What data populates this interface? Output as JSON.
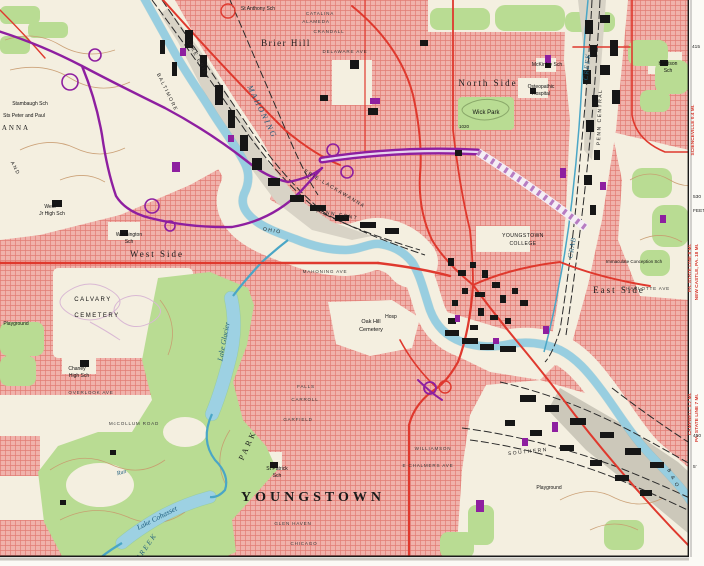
{
  "colors": {
    "urban_pink": "#f0b2ab",
    "urban_grid": "#dd6a62",
    "paper": "#f4efe0",
    "park_green": "#b9dc93",
    "water_fill": "#c2e4ef",
    "water_line": "#4aa6c6",
    "road_red": "#df392e",
    "road_purple": "#8e1fa0",
    "rail_gray": "#d8d3c6",
    "building_black": "#161616",
    "contour_brown": "#c89a6e",
    "margin_red": "#d63a30"
  },
  "labels": {
    "district": [
      {
        "t": "YOUNGSTOWN",
        "x": 313,
        "y": 501,
        "s": 14,
        "ls": 4,
        "n": "label-youngstown",
        "big": true
      },
      {
        "t": "North Side",
        "x": 488,
        "y": 86,
        "s": 9,
        "ls": 2,
        "n": "label-north-side"
      },
      {
        "t": "West Side",
        "x": 157,
        "y": 257,
        "s": 9,
        "ls": 2,
        "n": "label-west-side"
      },
      {
        "t": "East Side",
        "x": 619,
        "y": 293,
        "s": 9,
        "ls": 2,
        "n": "label-east-side"
      },
      {
        "t": "Brier Hill",
        "x": 286,
        "y": 46,
        "s": 9,
        "ls": 1.5,
        "n": "label-brier-hill"
      },
      {
        "t": "PARK",
        "x": 250,
        "y": 446,
        "r": -65,
        "s": 8,
        "ls": 3,
        "n": "label-mill-creek-park"
      },
      {
        "t": "ANNA",
        "x": 16,
        "y": 130,
        "s": 7,
        "ls": 2,
        "n": "label-anna"
      }
    ],
    "places": [
      {
        "t": "Wick Park",
        "x": 486,
        "y": 114,
        "s": 6
      },
      {
        "t": "CALVARY",
        "x": 93,
        "y": 301,
        "s": 6,
        "ls": 1.5
      },
      {
        "t": "CEMETERY",
        "x": 97,
        "y": 317,
        "s": 6,
        "ls": 1.5
      },
      {
        "t": "Oak Hill",
        "x": 371,
        "y": 323,
        "s": 5.5
      },
      {
        "t": "Cemetery",
        "x": 371,
        "y": 331,
        "s": 5.5
      },
      {
        "t": "Hosp",
        "x": 391,
        "y": 318,
        "s": 5
      },
      {
        "t": "YOUNGSTOWN",
        "x": 523,
        "y": 237,
        "s": 5,
        "ls": 0.5
      },
      {
        "t": "COLLEGE",
        "x": 523,
        "y": 245,
        "s": 5,
        "ls": 0.5
      },
      {
        "t": "St Anthony Sch",
        "x": 258,
        "y": 10,
        "s": 5
      },
      {
        "t": "Stambaugh Sch",
        "x": 30,
        "y": 105,
        "s": 5
      },
      {
        "t": "Sts Peter and Paul",
        "x": 24,
        "y": 117,
        "s": 5
      },
      {
        "t": "West",
        "x": 50,
        "y": 208,
        "s": 5
      },
      {
        "t": "Jr High Sch",
        "x": 52,
        "y": 215,
        "s": 5
      },
      {
        "t": "Washington",
        "x": 129,
        "y": 236,
        "s": 5
      },
      {
        "t": "Sch",
        "x": 129,
        "y": 243,
        "s": 5
      },
      {
        "t": "Chaney",
        "x": 77,
        "y": 370,
        "s": 5
      },
      {
        "t": "High Sch",
        "x": 79,
        "y": 377,
        "s": 5
      },
      {
        "t": "St Patrick",
        "x": 277,
        "y": 470,
        "s": 5
      },
      {
        "t": "Sch",
        "x": 277,
        "y": 477,
        "s": 5
      },
      {
        "t": "McKinley Sch",
        "x": 547,
        "y": 66,
        "s": 5
      },
      {
        "t": "Osteopathic",
        "x": 541,
        "y": 88,
        "s": 5
      },
      {
        "t": "Hospital",
        "x": 541,
        "y": 95,
        "s": 5
      },
      {
        "t": "Harrison",
        "x": 668,
        "y": 65,
        "s": 5
      },
      {
        "t": "Sch",
        "x": 668,
        "y": 72,
        "s": 5
      },
      {
        "t": "Immaculate Conception Sch",
        "x": 634,
        "y": 263,
        "s": 4.5
      },
      {
        "t": "Playground",
        "x": 549,
        "y": 489,
        "s": 5
      },
      {
        "t": "Playground",
        "x": 16,
        "y": 325,
        "s": 5
      },
      {
        "t": "1020",
        "x": 464,
        "y": 128,
        "s": 4.5
      }
    ],
    "water": [
      {
        "t": "MAHONING",
        "x": 260,
        "y": 113,
        "r": 64,
        "s": 8,
        "ls": 2,
        "n": "label-mahoning-river"
      },
      {
        "t": "Lake Glacier",
        "x": 226,
        "y": 342,
        "r": -79,
        "s": 7.5,
        "n": "label-lake-glacier"
      },
      {
        "t": "Lake Cohasset",
        "x": 158,
        "y": 520,
        "r": -27,
        "s": 7.5,
        "n": "label-lake-cohasset"
      },
      {
        "t": "CREEK",
        "x": 148,
        "y": 548,
        "r": -55,
        "s": 7,
        "ls": 2,
        "n": "label-mill-creek"
      },
      {
        "t": "CRAB",
        "x": 574,
        "y": 248,
        "r": -80,
        "s": 7,
        "ls": 1,
        "n": "label-crab-creek"
      },
      {
        "t": "CREEK",
        "x": 589,
        "y": 67,
        "r": -84,
        "s": 7,
        "ls": 1,
        "n": "label-crab-creek-upper"
      },
      {
        "t": "Run",
        "x": 122,
        "y": 474,
        "r": -15,
        "s": 6,
        "n": "label-run"
      }
    ],
    "rail": [
      {
        "t": "LAKE ERIE",
        "x": 196,
        "y": 58,
        "r": 62,
        "s": 5,
        "ls": 1.5
      },
      {
        "t": "BALTIMORE",
        "x": 166,
        "y": 93,
        "r": 64,
        "s": 5,
        "ls": 1.5
      },
      {
        "t": "AND",
        "x": 14,
        "y": 169,
        "r": 62,
        "s": 5,
        "ls": 1.5
      },
      {
        "t": "ERIE-LACKAWANNA",
        "x": 334,
        "y": 190,
        "r": 31,
        "s": 5,
        "ls": 1.5
      },
      {
        "t": "PENN CENT",
        "x": 337,
        "y": 216,
        "r": 10,
        "s": 5,
        "ls": 1.5
      },
      {
        "t": "PENN CENTRAL",
        "x": 601,
        "y": 117,
        "r": -88,
        "s": 5,
        "ls": 1.5
      },
      {
        "t": "SOUTHERN",
        "x": 528,
        "y": 453,
        "r": -6,
        "s": 5,
        "ls": 1.5
      },
      {
        "t": "B & O",
        "x": 672,
        "y": 479,
        "r": 62,
        "s": 5,
        "ls": 1.5
      },
      {
        "t": "OHIO",
        "x": 272,
        "y": 232,
        "r": 10,
        "s": 5,
        "ls": 1.5
      }
    ],
    "streets": [
      {
        "t": "CATALINA",
        "x": 320,
        "y": 15,
        "s": 4.6,
        "ls": 0.8
      },
      {
        "t": "ALAMEDA",
        "x": 316,
        "y": 23,
        "s": 4.6,
        "ls": 0.8
      },
      {
        "t": "CRANDALL",
        "x": 329,
        "y": 33,
        "s": 4.6,
        "ls": 0.8
      },
      {
        "t": "DELAWARE AVE",
        "x": 345,
        "y": 53,
        "s": 4.6,
        "ls": 0.8
      },
      {
        "t": "MAHONING AVE",
        "x": 325,
        "y": 273,
        "s": 4.6,
        "ls": 0.8
      },
      {
        "t": "OVERLOOK AVE",
        "x": 91,
        "y": 394,
        "s": 4.6,
        "ls": 0.8
      },
      {
        "t": "McCOLLUM ROAD",
        "x": 134,
        "y": 425,
        "s": 4.6,
        "ls": 0.8
      },
      {
        "t": "GARFIELD",
        "x": 298,
        "y": 421,
        "s": 4.6,
        "ls": 0.8
      },
      {
        "t": "CARROLL",
        "x": 305,
        "y": 401,
        "s": 4.6,
        "ls": 0.8
      },
      {
        "t": "FALLS",
        "x": 306,
        "y": 388,
        "s": 4.6,
        "ls": 0.8
      },
      {
        "t": "GLEN HAVEN",
        "x": 293,
        "y": 525,
        "s": 4.6,
        "ls": 0.8
      },
      {
        "t": "CHICAGO",
        "x": 304,
        "y": 545,
        "s": 4.6,
        "ls": 0.8
      },
      {
        "t": "WILLIAMSON",
        "x": 433,
        "y": 450,
        "s": 4.6,
        "ls": 0.8
      },
      {
        "t": "E CHALMERS AVE",
        "x": 428,
        "y": 467,
        "s": 4.6,
        "ls": 0.8
      },
      {
        "t": "CHARLOTTE AVE",
        "x": 646,
        "y": 290,
        "s": 4.6,
        "ls": 0.8
      }
    ],
    "margin_red": [
      {
        "t": "SCIENCEVILLE 0.4 MI.",
        "x": 694,
        "y": 130,
        "r": -90,
        "s": 4.8
      },
      {
        "t": "PA. STATE LINE 8 MI.",
        "x": 691,
        "y": 268,
        "r": -90,
        "s": 4.8
      },
      {
        "t": "NEW CASTLE, PA. 18 MI.",
        "x": 698,
        "y": 272,
        "r": -90,
        "s": 4.8
      },
      {
        "t": "CAMPBELL 1.7 MI.",
        "x": 691,
        "y": 414,
        "r": -90,
        "s": 4.8
      },
      {
        "t": "PA. STATE LINE 7 MI.",
        "x": 698,
        "y": 418,
        "r": -90,
        "s": 4.8
      }
    ],
    "margin_black": [
      {
        "t": "415",
        "x": 692,
        "y": 48,
        "s": 4.8,
        "a": "start"
      },
      {
        "t": "530",
        "x": 693,
        "y": 198,
        "s": 4.8,
        "a": "start"
      },
      {
        "t": "FEET",
        "x": 693,
        "y": 212,
        "s": 4.8,
        "a": "start"
      },
      {
        "t": "450",
        "x": 693,
        "y": 437,
        "s": 4.8,
        "a": "start"
      },
      {
        "t": "5'",
        "x": 693,
        "y": 468,
        "s": 4.8,
        "a": "start"
      }
    ]
  }
}
